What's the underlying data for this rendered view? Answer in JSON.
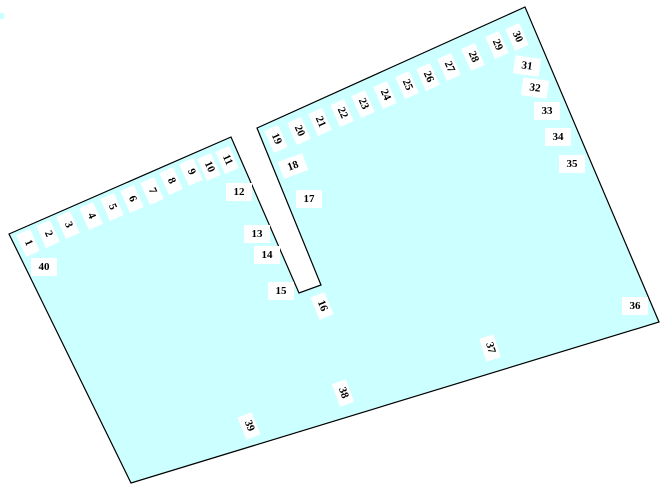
{
  "map": {
    "title": "lot-plan",
    "colors": {
      "lot_fill": "#ccffff",
      "lot_stroke": "#000000",
      "label_bg": "#ffffff",
      "label_text": "#000000",
      "page_bg": "#ffffff"
    },
    "outline": [
      [
        9,
        234
      ],
      [
        231,
        137
      ],
      [
        299,
        293
      ],
      [
        321,
        285
      ],
      [
        257,
        128
      ],
      [
        525,
        7
      ],
      [
        659,
        322
      ],
      [
        131,
        483
      ]
    ],
    "artifact": {
      "x": 0,
      "y": 13,
      "w": 4,
      "h": 6
    },
    "stalls": [
      {
        "n": "1",
        "x": 28,
        "y": 243,
        "rot": 66
      },
      {
        "n": "2",
        "x": 48,
        "y": 234,
        "rot": 66
      },
      {
        "n": "3",
        "x": 68,
        "y": 225,
        "rot": 66
      },
      {
        "n": "4",
        "x": 91,
        "y": 216,
        "rot": 66
      },
      {
        "n": "5",
        "x": 112,
        "y": 207,
        "rot": 66
      },
      {
        "n": "6",
        "x": 132,
        "y": 199,
        "rot": 66
      },
      {
        "n": "7",
        "x": 152,
        "y": 191,
        "rot": 66
      },
      {
        "n": "8",
        "x": 171,
        "y": 181,
        "rot": 66
      },
      {
        "n": "9",
        "x": 191,
        "y": 172,
        "rot": 66
      },
      {
        "n": "10",
        "x": 209,
        "y": 167,
        "rot": 66
      },
      {
        "n": "11",
        "x": 227,
        "y": 160,
        "rot": 66
      },
      {
        "n": "12",
        "x": 239,
        "y": 192,
        "rot": 0
      },
      {
        "n": "13",
        "x": 257,
        "y": 234,
        "rot": 0
      },
      {
        "n": "14",
        "x": 267,
        "y": 255,
        "rot": 0
      },
      {
        "n": "15",
        "x": 281,
        "y": 291,
        "rot": 0
      },
      {
        "n": "16",
        "x": 322,
        "y": 306,
        "rot": 68
      },
      {
        "n": "17",
        "x": 309,
        "y": 199,
        "rot": 0
      },
      {
        "n": "18",
        "x": 293,
        "y": 166,
        "rot": -20
      },
      {
        "n": "19",
        "x": 276,
        "y": 139,
        "rot": 66
      },
      {
        "n": "20",
        "x": 299,
        "y": 131,
        "rot": 66
      },
      {
        "n": "21",
        "x": 320,
        "y": 122,
        "rot": 66
      },
      {
        "n": "22",
        "x": 342,
        "y": 113,
        "rot": 66
      },
      {
        "n": "23",
        "x": 363,
        "y": 104,
        "rot": 66
      },
      {
        "n": "24",
        "x": 385,
        "y": 95,
        "rot": 66
      },
      {
        "n": "25",
        "x": 407,
        "y": 85,
        "rot": 66
      },
      {
        "n": "26",
        "x": 428,
        "y": 77,
        "rot": 66
      },
      {
        "n": "27",
        "x": 449,
        "y": 67,
        "rot": 66
      },
      {
        "n": "28",
        "x": 473,
        "y": 57,
        "rot": 66
      },
      {
        "n": "29",
        "x": 497,
        "y": 45,
        "rot": 66
      },
      {
        "n": "30",
        "x": 517,
        "y": 37,
        "rot": 66
      },
      {
        "n": "31",
        "x": 527,
        "y": 66,
        "rot": 8
      },
      {
        "n": "32",
        "x": 535,
        "y": 88,
        "rot": 8
      },
      {
        "n": "33",
        "x": 547,
        "y": 111,
        "rot": 0
      },
      {
        "n": "34",
        "x": 558,
        "y": 137,
        "rot": 0
      },
      {
        "n": "35",
        "x": 572,
        "y": 164,
        "rot": 0
      },
      {
        "n": "36",
        "x": 635,
        "y": 306,
        "rot": 0
      },
      {
        "n": "37",
        "x": 490,
        "y": 348,
        "rot": 73
      },
      {
        "n": "38",
        "x": 343,
        "y": 393,
        "rot": 70
      },
      {
        "n": "39",
        "x": 249,
        "y": 426,
        "rot": 68
      },
      {
        "n": "40",
        "x": 44,
        "y": 267,
        "rot": 0
      }
    ]
  }
}
